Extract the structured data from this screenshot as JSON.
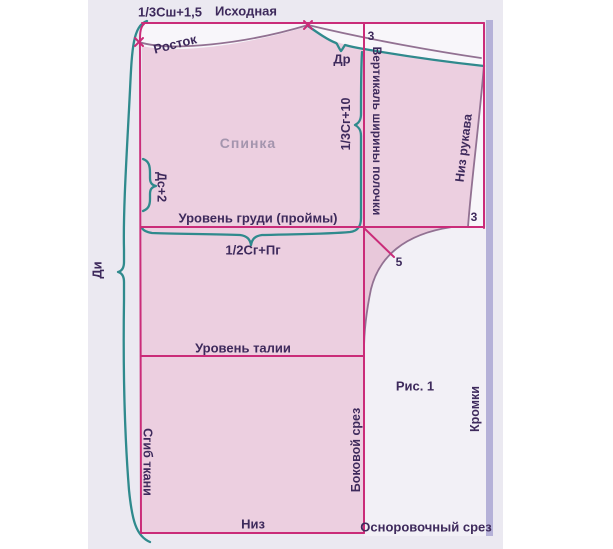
{
  "figure_caption": "Рис. 1",
  "labels": {
    "top_formula": "1/3Сш+1,5",
    "initial_line": "Исходная",
    "neckline": "Росток",
    "shoulder_drop": "Др",
    "front_width_vertical": "Вертикаль ширины полочки",
    "armhole_depth_formula": "1/3Сг+10",
    "back_piece": "Спинка",
    "back_length_formula": "Дс+2",
    "sleeve_hem": "Низ рукава",
    "chest_line": "Уровень груди (проймы)",
    "half_chest_formula": "1/2Сг+Пг",
    "garment_length": "Ди",
    "waist_line": "Уровень талии",
    "selvage": "Кромки",
    "fabric_fold": "Сгиб ткани",
    "side_cut": "Боковой срез",
    "hem": "Низ",
    "leveling_cut": "Осноровочный срез"
  },
  "marks": {
    "three_top": "3",
    "three_sleeve": "3",
    "five": "5"
  },
  "colors": {
    "outline_magenta": "#ca2c79",
    "guide_teal": "#2f8a8d",
    "seam_gray_purple": "#927192",
    "pattern_fill_pink": "#eccfe0",
    "gusset_fill_pink": "#e8c8da",
    "label_purple": "#3e2a5c",
    "back_label_gray": "#a495ae",
    "selvage_bar_lavender": "#b5b1d8",
    "panel_background": "#ebe9f1",
    "paper_white": "#f8f6fa"
  }
}
